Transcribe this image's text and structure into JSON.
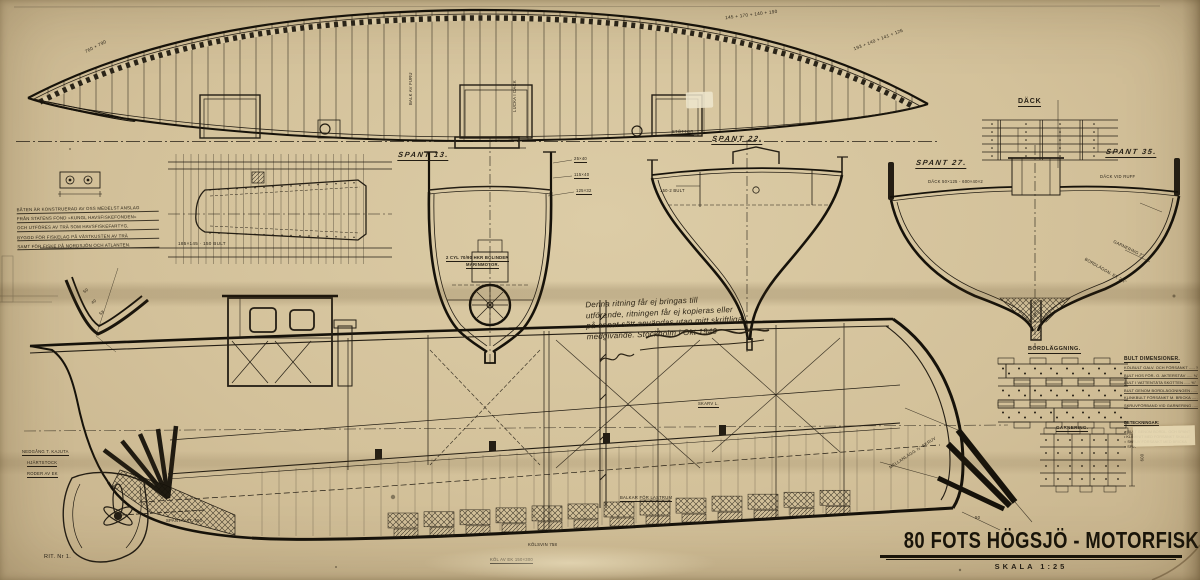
{
  "title": {
    "main": "80 FOTS HÖGSJÖ - MOTORFISKEBÅT.",
    "scale": "SKALA 1:25"
  },
  "deck_plan": {
    "label": "DÄCK",
    "dim_left": "760 + 790",
    "dim_mid": "145 + 170 + 140 + 190",
    "dim_right": "193 + 140 + 141 + 126",
    "beam_note_1": "BALK AV FURU",
    "beam_note_2": "LUCKA I DÄCK"
  },
  "sections": {
    "s13": {
      "label": "SPANT 13.",
      "engine_1": "2 CYL 70/90 HKR BOLINDER",
      "engine_2": "MARINMOTOR.",
      "dim_1": "25×40",
      "dim_2": "115×40",
      "dim_3": "125×32"
    },
    "s22": {
      "label": "SPANT 22.",
      "note": "STÖTTOR",
      "dim_1": "150·2 BULT"
    },
    "s27": {
      "label": "SPANT 27.",
      "deck_dim": "DÄCK 50×125 - 600×40×2"
    },
    "s35": {
      "label": "SPANT 35.",
      "note": "DÄCK VID RUFF",
      "dim_1": "GARNERING 2\"",
      "dim_2": "BORDLÄGGN. EK 2¼\""
    }
  },
  "keel_detail": {
    "dim": "185×145 · 150 BULT"
  },
  "stem_detail": {
    "note": "MELLANLÄGG ⅞\" SKRUV",
    "dim": "50"
  },
  "curve_detail": {
    "d1": "50",
    "d2": "40",
    "d3": "58"
  },
  "notes": {
    "left": [
      "BÅTEN ÄR KONSTRUERAD AV OSS MEDELST ANSLAG",
      "FRÅN STATENS FOND »KUNGL HAVSFISKEFONDEN»",
      "OCH UTFÖRES AV TRÄ SOM HAVSFISKEFARTYG,",
      "BYGGD FÖR FISKELAG PÅ VÄSTKUSTEN AV TRÄ",
      "SAMT FÖR FISKE PÅ NORDSJÖN OCH ATLANTEN."
    ],
    "hand": [
      "Denna ritning får ej bringas till",
      "utförande, ritningen får ej kopieras eller",
      "på annat sätt användas utan mitt skriftliga",
      "medgivande.  Stockholm i Okt 1940"
    ]
  },
  "profile": {
    "nedgang": "NEDGÅNG T. KAJUTA",
    "hjartstock": "HJÄRTSTOCK",
    "roder": "RODER AV EK",
    "skarv": "SKARV L.",
    "balkar": "BALKAR FÖR LASTRUM",
    "kolsvin": "KÖLSVIN 758",
    "kol": "KÖL AV EK 150×300",
    "spant_dim": "SPANTAVST. 550",
    "rit": "RIT. Nr 1."
  },
  "tables": {
    "bord_label": "BORDLÄGGNING.",
    "garn_label": "GARNERING.",
    "garn_dim": "600",
    "bult": {
      "title": "BULT DIMENSIONER.",
      "rows": [
        "KÖLBULT GALV. OCH FÖRSÄNKT ..... ⅞\"",
        "BULT HOS FÖR- O. AKTERSTÄV ..... ¾\"",
        "BULT I VATTENTÄTA SKOTTEN ..... ⅝\"",
        "BULT GENOM BORDLÄGGNINGEN ..... ⅝\"",
        "KLINKBULT FÖRSÄNKT M. BRICKA ..... ½\"",
        "SKRUVFÖRBAND VID GARNERING ..... ⅜\""
      ],
      "legend_title": "BETECKNINGAR:",
      "legend": [
        "⌀  BULT GENOM BORDL. OCH SPANT",
        "•  KLINKNIT MED FÖRSÄNKT SKALLE",
        "○  SKRUV FÖRSÄNKT MED BRICKA",
        "×  SPIK"
      ]
    }
  },
  "colors": {
    "paper": "#d3c19a",
    "ink": "#241e14"
  }
}
